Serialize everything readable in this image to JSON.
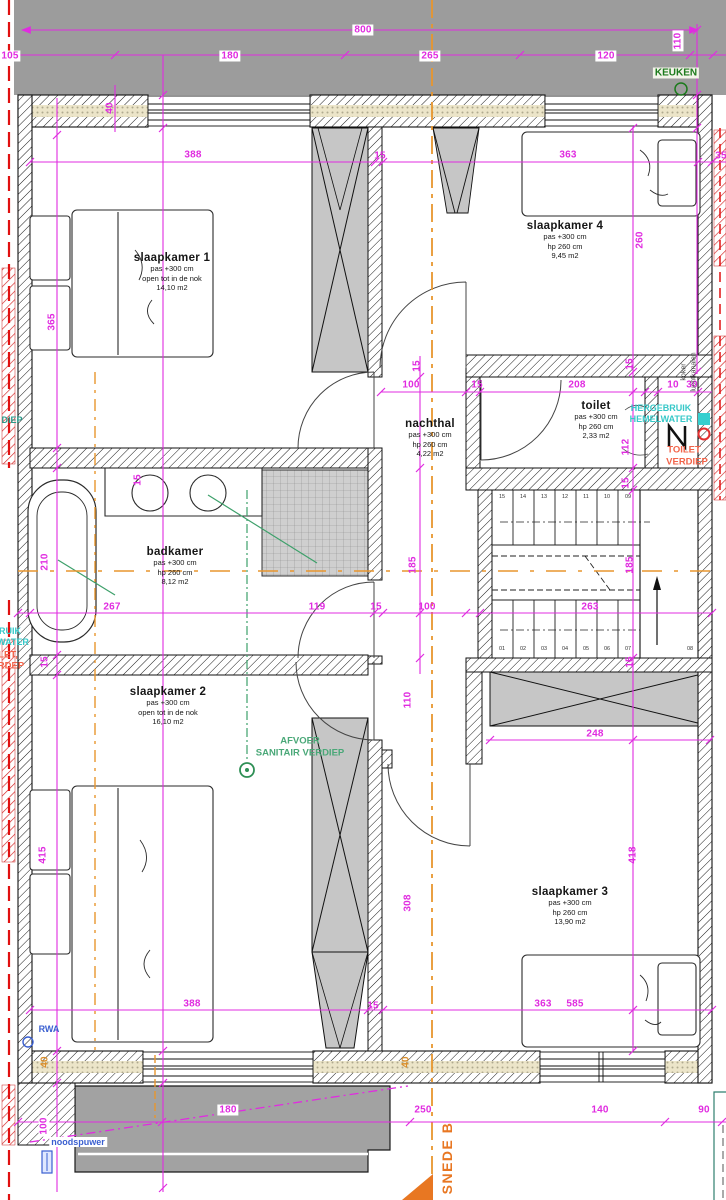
{
  "drawing_title": "verdieping floor plan",
  "colors": {
    "dimension": "#e02ce0",
    "orange_section": "#e8962e",
    "orange_marker": "#e87722",
    "green_label": "#1c7a1c",
    "green_sanitary": "#4aa878",
    "cyan_label": "#36c8c8",
    "red_label": "#f2644a",
    "blue_label": "#3a5fd0",
    "red_party_wall": "#d42020",
    "gray_roof": "#9c9c9c",
    "gray_block": "#c6c6c6"
  },
  "rooms": [
    {
      "id": "slaapkamer-1",
      "name": "slaapkamer 1",
      "lines": [
        "pas +300 cm",
        "open tot in de nok",
        "14,10 m2"
      ],
      "x": 172,
      "y": 252
    },
    {
      "id": "slaapkamer-4",
      "name": "slaapkamer 4",
      "lines": [
        "pas +300 cm",
        "hp 260 cm",
        "9,45 m2"
      ],
      "x": 565,
      "y": 220
    },
    {
      "id": "nachthal",
      "name": "nachthal",
      "lines": [
        "pas +300 cm",
        "hp 260 cm",
        "4,22 m2"
      ],
      "x": 430,
      "y": 418
    },
    {
      "id": "toilet",
      "name": "toilet",
      "lines": [
        "pas +300 cm",
        "hp 260 cm",
        "2,33 m2"
      ],
      "x": 596,
      "y": 400
    },
    {
      "id": "badkamer",
      "name": "badkamer",
      "lines": [
        "pas +300 cm",
        "hp 260 cm",
        "8,12 m2"
      ],
      "x": 175,
      "y": 546
    },
    {
      "id": "slaapkamer-2",
      "name": "slaapkamer 2",
      "lines": [
        "pas +300 cm",
        "open tot in de nok",
        "16,10 m2"
      ],
      "x": 168,
      "y": 686
    },
    {
      "id": "slaapkamer-3",
      "name": "slaapkamer 3",
      "lines": [
        "pas +300 cm",
        "hp 260 cm",
        "13,90 m2"
      ],
      "x": 570,
      "y": 886
    }
  ],
  "dimensions": [
    {
      "t": "800",
      "x": 363,
      "y": 30,
      "boxed": true
    },
    {
      "t": "105",
      "x": 10,
      "y": 56,
      "boxed": true
    },
    {
      "t": "180",
      "x": 230,
      "y": 56,
      "boxed": true
    },
    {
      "t": "265",
      "x": 430,
      "y": 56,
      "boxed": true
    },
    {
      "t": "120",
      "x": 606,
      "y": 56,
      "boxed": true
    },
    {
      "t": "110",
      "x": 678,
      "y": 41,
      "rot": true,
      "boxed": true
    },
    {
      "t": "40",
      "x": 110,
      "y": 108,
      "rot": true
    },
    {
      "t": "388",
      "x": 193,
      "y": 155
    },
    {
      "t": "15",
      "x": 380,
      "y": 156
    },
    {
      "t": "363",
      "x": 568,
      "y": 155
    },
    {
      "t": "35",
      "x": 721,
      "y": 156
    },
    {
      "t": "365",
      "x": 52,
      "y": 322,
      "rot": true
    },
    {
      "t": "260",
      "x": 640,
      "y": 240,
      "rot": true
    },
    {
      "t": "15",
      "x": 417,
      "y": 366,
      "rot": true
    },
    {
      "t": "15",
      "x": 630,
      "y": 364,
      "rot": true
    },
    {
      "t": "100",
      "x": 411,
      "y": 385
    },
    {
      "t": "15",
      "x": 477,
      "y": 385
    },
    {
      "t": "208",
      "x": 577,
      "y": 385
    },
    {
      "t": "10",
      "x": 673,
      "y": 385
    },
    {
      "t": "30",
      "x": 692,
      "y": 385
    },
    {
      "t": "112",
      "x": 626,
      "y": 447,
      "rot": true
    },
    {
      "t": "15",
      "x": 626,
      "y": 483,
      "rot": true
    },
    {
      "t": "185",
      "x": 413,
      "y": 565,
      "rot": true
    },
    {
      "t": "185",
      "x": 630,
      "y": 565,
      "rot": true
    },
    {
      "t": "15",
      "x": 138,
      "y": 480,
      "rot": true
    },
    {
      "t": "210",
      "x": 45,
      "y": 562,
      "rot": true
    },
    {
      "t": "267",
      "x": 112,
      "y": 607
    },
    {
      "t": "119",
      "x": 317,
      "y": 607
    },
    {
      "t": "15",
      "x": 376,
      "y": 607
    },
    {
      "t": "100",
      "x": 427,
      "y": 607
    },
    {
      "t": "263",
      "x": 590,
      "y": 607
    },
    {
      "t": "15",
      "x": 45,
      "y": 662,
      "rot": true
    },
    {
      "t": "15",
      "x": 630,
      "y": 662,
      "rot": true
    },
    {
      "t": "415",
      "x": 43,
      "y": 855,
      "rot": true
    },
    {
      "t": "110",
      "x": 408,
      "y": 700,
      "rot": true
    },
    {
      "t": "308",
      "x": 408,
      "y": 903,
      "rot": true
    },
    {
      "t": "248",
      "x": 595,
      "y": 734
    },
    {
      "t": "418",
      "x": 633,
      "y": 855,
      "rot": true
    },
    {
      "t": "388",
      "x": 192,
      "y": 1004
    },
    {
      "t": "15",
      "x": 373,
      "y": 1006
    },
    {
      "t": "363",
      "x": 543,
      "y": 1004
    },
    {
      "t": "585",
      "x": 575,
      "y": 1004
    },
    {
      "t": "40",
      "x": 45,
      "y": 1062,
      "rot": true,
      "orange": true
    },
    {
      "t": "40",
      "x": 406,
      "y": 1062,
      "rot": true,
      "orange": true
    },
    {
      "t": "100",
      "x": 44,
      "y": 1126,
      "rot": true,
      "boxed": true
    },
    {
      "t": "180",
      "x": 228,
      "y": 1110,
      "boxed": true
    },
    {
      "t": "250",
      "x": 423,
      "y": 1110
    },
    {
      "t": "140",
      "x": 600,
      "y": 1110
    },
    {
      "t": "90",
      "x": 704,
      "y": 1110
    }
  ],
  "annotations": [
    {
      "id": "keuken-label",
      "t": "KEUKEN",
      "x": 676,
      "y": 73,
      "cls": "green-bold"
    },
    {
      "id": "hergebruik-line1",
      "t": "HERGEBRUIK",
      "x": 661,
      "y": 408,
      "cls": "cyan"
    },
    {
      "id": "hergebruik-line2",
      "t": "HEMELWATER",
      "x": 661,
      "y": 419,
      "cls": "cyan"
    },
    {
      "id": "toilet-verdiep-line1",
      "t": "TOILET",
      "x": 684,
      "y": 450,
      "cls": "redann"
    },
    {
      "id": "toilet-verdiep-line2",
      "t": "VERDIEP",
      "x": 687,
      "y": 462,
      "cls": "redann"
    },
    {
      "id": "afvoer-line1",
      "t": "AFVOER",
      "x": 300,
      "y": 741,
      "cls": "greenmed"
    },
    {
      "id": "afvoer-line2",
      "t": "SANITAIR VERDIEP",
      "x": 300,
      "y": 753,
      "cls": "greenmed"
    },
    {
      "id": "rwa-label",
      "t": "RWA",
      "x": 49,
      "y": 1029,
      "cls": "blue"
    },
    {
      "id": "noodspuwer-label",
      "t": "noodspuwer",
      "x": 78,
      "y": 1142,
      "cls": "blue boxedw"
    },
    {
      "id": "koker-label",
      "t": "koker",
      "x": 684,
      "y": 372,
      "cls": "tinyrot rot"
    },
    {
      "id": "luchtkanalen-label",
      "t": "luchtkanalen",
      "x": 694,
      "y": 372,
      "cls": "tinyrot rot"
    },
    {
      "id": "snede-b-label",
      "t": "SNEDE B",
      "x": 447,
      "y": 1158,
      "cls": "orange-big rot"
    },
    {
      "id": "edge-fragment-verdiep",
      "t": "DIEP",
      "x": 12,
      "y": 420,
      "cls": "teal"
    },
    {
      "id": "edge-fragment-ruik",
      "t": "RUIK",
      "x": 10,
      "y": 631,
      "cls": "cyan"
    },
    {
      "id": "edge-fragment-water",
      "t": "WATER",
      "x": 13,
      "y": 642,
      "cls": "cyan"
    },
    {
      "id": "edge-fragment-let",
      "t": "LET,",
      "x": 8,
      "y": 655,
      "cls": "redann"
    },
    {
      "id": "edge-fragment-rdep",
      "t": "RDEP",
      "x": 11,
      "y": 666,
      "cls": "redann"
    }
  ],
  "stairs": {
    "labels": [
      {
        "t": "15",
        "x": 502,
        "y": 497
      },
      {
        "t": "14",
        "x": 523,
        "y": 497
      },
      {
        "t": "13",
        "x": 544,
        "y": 497
      },
      {
        "t": "12",
        "x": 565,
        "y": 497
      },
      {
        "t": "11",
        "x": 586,
        "y": 497
      },
      {
        "t": "10",
        "x": 607,
        "y": 497
      },
      {
        "t": "09",
        "x": 628,
        "y": 497
      },
      {
        "t": "01",
        "x": 502,
        "y": 649
      },
      {
        "t": "02",
        "x": 523,
        "y": 649
      },
      {
        "t": "03",
        "x": 544,
        "y": 649
      },
      {
        "t": "04",
        "x": 565,
        "y": 649
      },
      {
        "t": "05",
        "x": 586,
        "y": 649
      },
      {
        "t": "06",
        "x": 607,
        "y": 649
      },
      {
        "t": "07",
        "x": 628,
        "y": 649
      },
      {
        "t": "08",
        "x": 690,
        "y": 649
      }
    ]
  }
}
